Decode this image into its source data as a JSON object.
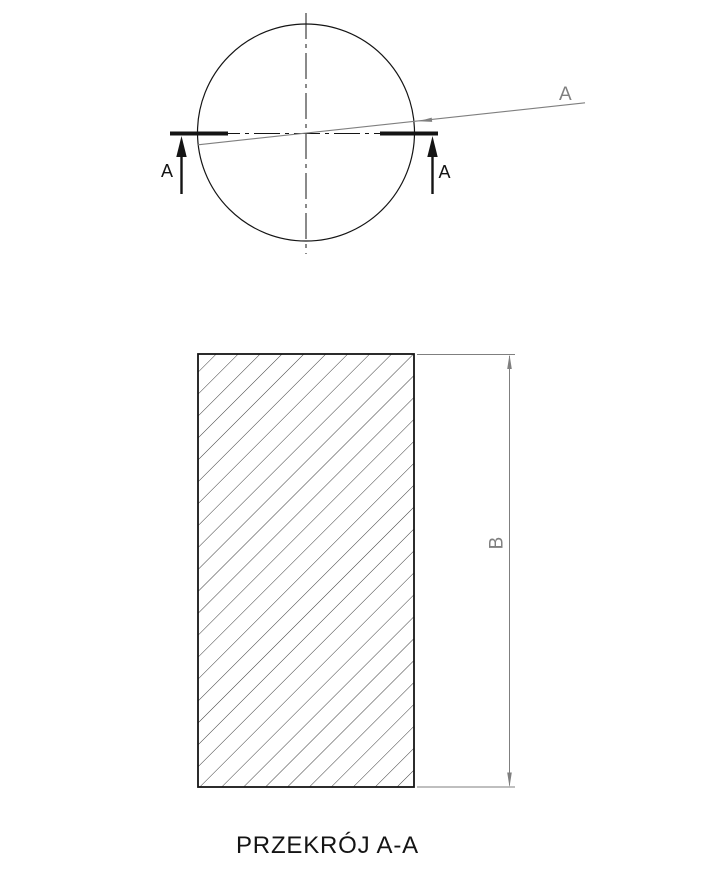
{
  "drawing": {
    "caption": "PRZEKRÓJ A-A",
    "labels": {
      "section_arrow_left": "A",
      "section_arrow_right": "A",
      "cutting_plane": "A",
      "dimension": "B"
    },
    "colors": {
      "line": "#141414",
      "annotation_gray": "#7f7f7f",
      "hatch": "#3d3d3d",
      "background": "#ffffff"
    }
  }
}
